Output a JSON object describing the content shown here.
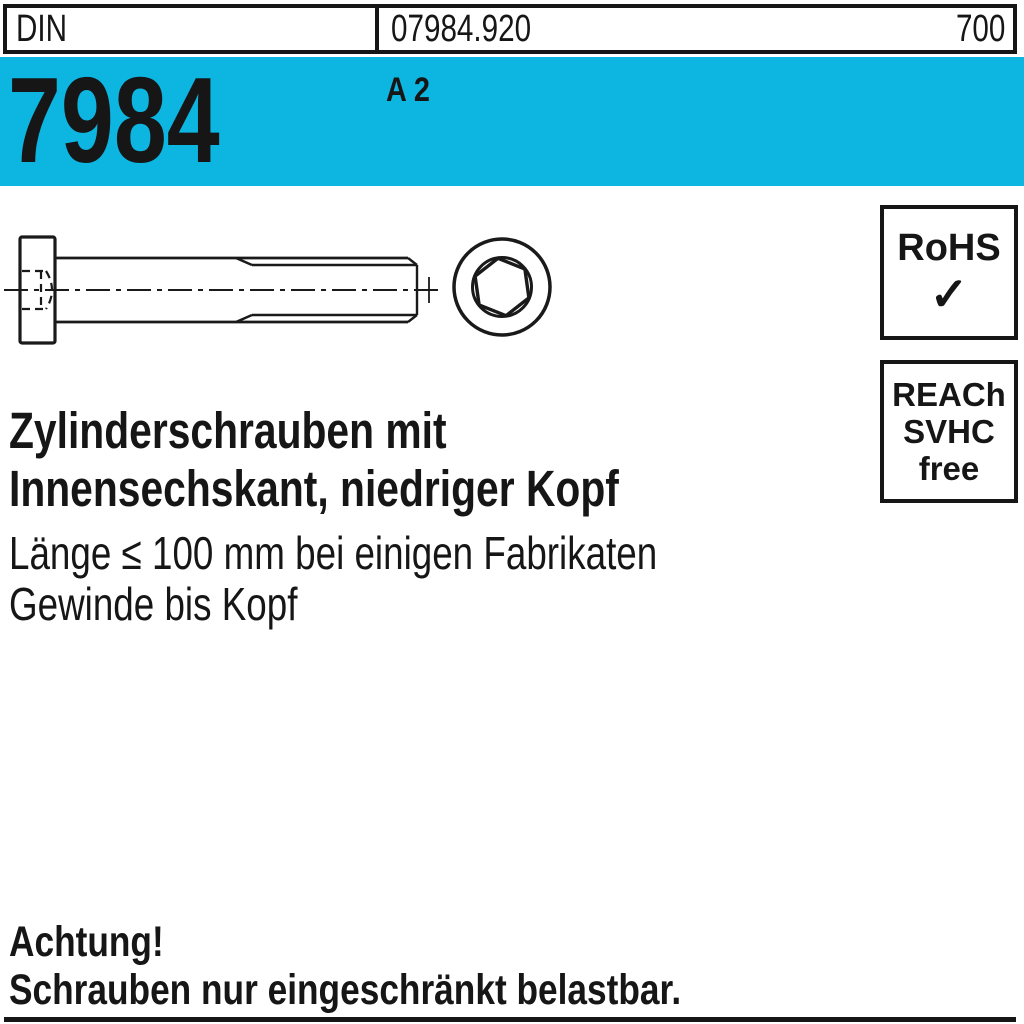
{
  "header": {
    "standard_org": "DIN",
    "article_number": "07984.920",
    "page_number": "700"
  },
  "banner": {
    "standard_number": "7984",
    "material": "A 2",
    "background_color": "#0db5e1"
  },
  "compliance": {
    "rohs": {
      "label": "RoHS",
      "check": "✓"
    },
    "reach": {
      "line1": "REACh",
      "line2": "SVHC",
      "line3": "free"
    }
  },
  "description": {
    "title_line1": "Zylinderschrauben mit",
    "title_line2": "Innensechskant, niedriger Kopf",
    "note_line1": "Länge ≤ 100 mm bei einigen Fabrikaten",
    "note_line2": "Gewinde bis Kopf"
  },
  "warning": {
    "heading": "Achtung!",
    "text": "Schrauben nur eingeschränkt belastbar."
  },
  "drawing": {
    "subject": "Zylinderschraube mit Innensechskant, Seitenansicht und Stirnansicht"
  }
}
